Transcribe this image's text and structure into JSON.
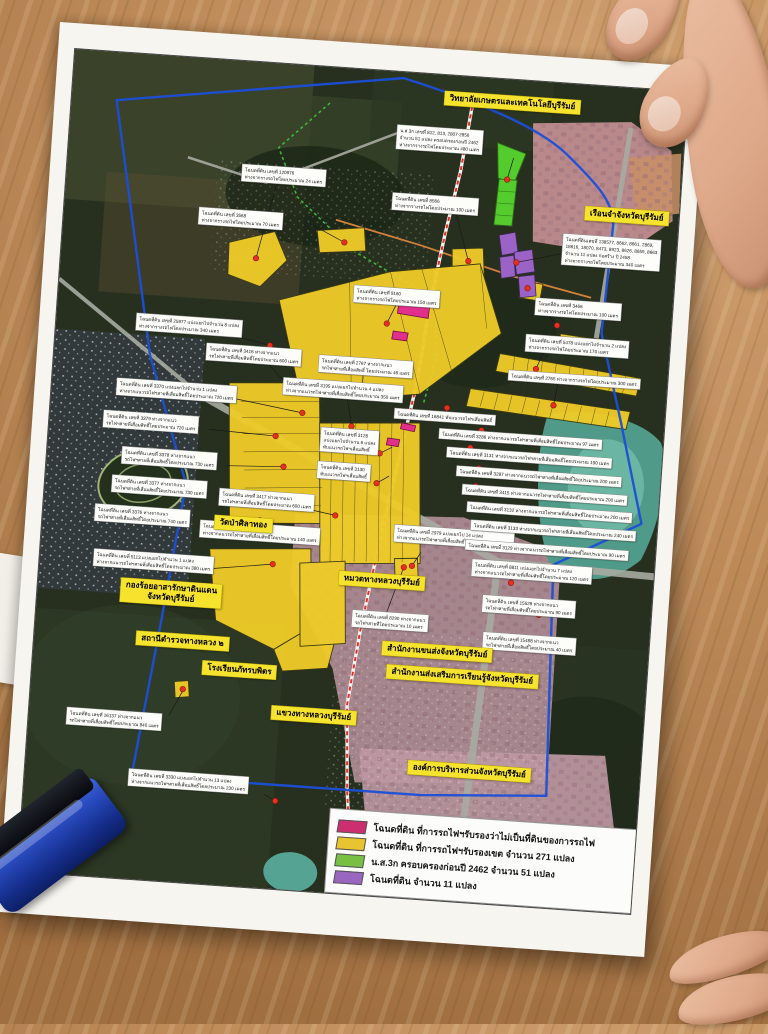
{
  "scene": {
    "description": "photo of printed land-survey map poster on wooden table",
    "objects": [
      "map-poster",
      "blue-self-inking-stamp",
      "hand-top-right",
      "hand-bottom-right",
      "paper-sheet-under-poster"
    ]
  },
  "map_colors": {
    "boundary_blue": "#1b4fd8",
    "railway_red": "#e03222",
    "survey_green": "#3db53d",
    "road_orange": "#d2813a",
    "marker_red": "#e5301f",
    "parcel_yellow": "#eecb28",
    "parcel_green": "#55cc2e",
    "parcel_purple": "#9c63c6",
    "parcel_pink": "#e0308c"
  },
  "legend": {
    "items": [
      {
        "color": "#cc2f70",
        "label": "โฉนดที่ดิน ที่การรถไฟฯรับรองว่าไม่เป็นที่ดินของการรถไฟ"
      },
      {
        "color": "#e9c431",
        "label": "โฉนดที่ดิน ที่การรถไฟฯรับรองเขต จำนวน 271 แปลง"
      },
      {
        "color": "#77c043",
        "label": "น.ส.3ก ครอบครองก่อนปี 2462 จำนวน 51 แปลง"
      },
      {
        "color": "#9a67c0",
        "label": "โฉนดที่ดิน จำนวน 11 แปลง"
      }
    ]
  },
  "place_labels": [
    {
      "x": 372,
      "y": 16,
      "lines": [
        "วิทยาลัยเกษตรและเทคโนโลยีบุรีรัมย์"
      ]
    },
    {
      "x": 520,
      "y": 121,
      "lines": [
        "เรือนจำจังหวัดบุรีรัมย์"
      ]
    },
    {
      "x": 83,
      "y": 524,
      "lines": [
        "กองร้อยอาสารักษาดินแดน",
        "จังหวัดบุรีรัมย์"
      ]
    },
    {
      "x": 102,
      "y": 576,
      "lines": [
        "สถานีตำรวจทางหลวง ๒"
      ]
    },
    {
      "x": 172,
      "y": 455,
      "lines": [
        "วัดป่าศิลาทอง"
      ]
    },
    {
      "x": 300,
      "y": 502,
      "lines": [
        "หมวดทางหลวงบุรีรัมย์"
      ]
    },
    {
      "x": 348,
      "y": 569,
      "lines": [
        "สำนักงานขนส่งจังหวัดบุรีรัมย์"
      ]
    },
    {
      "x": 354,
      "y": 592,
      "lines": [
        "สำนักงานส่งเสริมการเรียนรู้จังหวัดบุรีรัมย์"
      ]
    },
    {
      "x": 170,
      "y": 601,
      "lines": [
        "โรงเรียนภัทรบพิตร"
      ]
    },
    {
      "x": 242,
      "y": 641,
      "lines": [
        "แขวงทางหลวงบุรีรัมย์"
      ]
    },
    {
      "x": 382,
      "y": 686,
      "lines": [
        "องค์การบริหารส่วนจังหวัดบุรีรัมย์"
      ]
    }
  ],
  "parcel_labels": [
    {
      "x": 175,
      "y": 103,
      "lines": [
        "โฉนดที่ดิน เลขที่ 120976",
        "ห่างจากรางรถไฟโดยประมาณ 24 เมตร"
      ]
    },
    {
      "x": 135,
      "y": 149,
      "lines": [
        "โฉนดที่ดิน เลขที่ 3568",
        "ห่างจากรางรถไฟโดยประมาณ 70 เมตร"
      ]
    },
    {
      "x": 327,
      "y": 121,
      "lines": [
        "โฉนดที่ดิน เลขที่ 8566",
        "ห่างจากรางรถไฟโดยประมาณ 100 เมตร"
      ]
    },
    {
      "x": 327,
      "y": 53,
      "lines": [
        "น.ส.3ก เลขที่ 812, 813, 2807-2856",
        "จำนวน 51 แปลง ครอบครองก่อนปี 2462",
        "ห่างจากรางรถไฟโดยประมาณ 480 เมตร"
      ]
    },
    {
      "x": 295,
      "y": 216,
      "lines": [
        "โฉนดที่ดิน เลขที่ 9160",
        "ห่างจากรางรถไฟโดยประมาณ 150 เมตร"
      ]
    },
    {
      "x": 500,
      "y": 150,
      "lines": [
        "โฉนดที่ดินเลขที่ 138577, 8662, 8661, 2869,",
        "18616, 18070, 8473, 8923, 8626, 8659, 8663",
        "จำนวน 11 แปลง ก่อสร้าง ปี 2458",
        "ห่างจากรางรถไฟโดยประมาณ 340 เมตร"
      ]
    },
    {
      "x": 477,
      "y": 216,
      "lines": [
        "โฉนดที่ดิน เลขที่ 3466",
        "ห่างจากรางรถไฟโดยประมาณ 100 เมตร"
      ]
    },
    {
      "x": 470,
      "y": 253,
      "lines": [
        "โฉนดที่ดิน เลขที่ 5478 แบ่งแยกไปจำนวน 2 แปลง",
        "ห่างจากรางรถไฟโดยประมาณ 170 เมตร"
      ]
    },
    {
      "x": 455,
      "y": 290,
      "lines": [
        "โฉนดที่ดิน เลขที่ 2765 ห่างจากรางรถไฟโดยประมาณ 300 เมตร"
      ]
    },
    {
      "x": 80,
      "y": 259,
      "lines": [
        "โฉนดที่ดิน เลขที่ 25977 แบ่งแยกไปจำนวน 8 แปลง",
        "ห่างจากรางรถไฟโดยประมาณ 340 เมตร"
      ]
    },
    {
      "x": 152,
      "y": 284,
      "lines": [
        "โฉนดที่ดิน เลขที่ 3416 ห่างจากแนว",
        "รถไฟฯสายที่เสื่อมสิทธิ์โดยประมาณ 600 เมตร"
      ]
    },
    {
      "x": 265,
      "y": 288,
      "lines": [
        "โฉนดที่ดิน เลขที่ 2767 ห่างจากแนว",
        "รถไฟฯสายที่เสื่อมสิทธิ์ โดยประมาณ 46 เมตร"
      ]
    },
    {
      "x": 231,
      "y": 313,
      "lines": [
        "โฉนดที่ดิน เลขที่ 3195 แบ่งแยกไปจำนวน 4 แปลง",
        "ห่างจากแนวรถไฟฯสายที่เสื่อมสิทธิ์โดยประมาณ 350 เมตร"
      ]
    },
    {
      "x": 65,
      "y": 325,
      "lines": [
        "โฉนดที่ดิน เลขที่ 3370 แบ่งแยกไปจำนวน 1 แปลง",
        "ห่างจากแนวรถไฟฯสายที่เสื่อมสิทธิ์โดยประมาณ 720 เมตร"
      ]
    },
    {
      "x": 54,
      "y": 358,
      "lines": [
        "โฉนดที่ดิน เลขที่ 3379 ห่างจากแนว",
        "รถไฟฯสายที่เสื่อมสิทธิ์โดยประมาณ 720 เมตร"
      ]
    },
    {
      "x": 75,
      "y": 393,
      "lines": [
        "โฉนดที่ดิน เลขที่ 3378 ห่างจากแนว",
        "รถไฟฯสายที่เสื่อมสิทธิ์โดยประมาณ 730 เมตร"
      ]
    },
    {
      "x": 67,
      "y": 422,
      "lines": [
        "โฉนดที่ดิน เลขที่ 3377 ห่างจากแนว",
        "รถไฟฯสายที่เสื่อมสิทธิ์โดยประมาณ 730 เมตร"
      ]
    },
    {
      "x": 52,
      "y": 452,
      "lines": [
        "โฉนดที่ดิน เลขที่ 3376 ห่างจากแนว",
        "รถไฟฯสายที่เสื่อมสิทธิ์โดยประมาณ 740 เมตร"
      ]
    },
    {
      "x": 54,
      "y": 497,
      "lines": [
        "โฉนดที่ดิน เลขที่ 5113 แบ่งแยกไปจำนวน 1 แปลง",
        "ห่างจากแนวรถไฟฯสายที่เสื่อมสิทธิ์โดยประมาณ 380 เมตร"
      ]
    },
    {
      "x": 175,
      "y": 428,
      "lines": [
        "โฉนดที่ดิน เลขที่ 3417 ห่างจากแนว",
        "รถไฟฯสายที่เสื่อมสิทธิ์โดยประมาณ 600 เมตร"
      ]
    },
    {
      "x": 158,
      "y": 461,
      "lines": [
        "โฉนดที่ดิน  65 แปลง",
        "ห่างจากแนวรถไฟฯสายที่เสื่อมสิทธิ์โดยประมาณ 140 เมตร"
      ]
    },
    {
      "x": 352,
      "y": 452,
      "lines": [
        "โฉนดที่ดิน เลขที่ 2979 แบ่งแยกไป 14 แปลง",
        "ห่างจากแนวรถไฟฯสายที่เสื่อมสิทธิ์โดยประมาณ 130 เมตร"
      ]
    },
    {
      "x": 272,
      "y": 360,
      "lines": [
        "โฉนดที่ดิน เลขที่ 3128",
        "แบ่งแยกไปจำนวน 6 แปลง",
        "ทับแนวรถไฟฯเสื่อมสิทธิ์"
      ]
    },
    {
      "x": 271,
      "y": 394,
      "lines": [
        "โฉนดที่ดิน เลขที่ 3130",
        "ทับแนวรถไฟฯเสื่อมสิทธิ์"
      ]
    },
    {
      "x": 344,
      "y": 336,
      "lines": [
        "โฉนดที่ดิน เลขที่ 16841 ทับแนวรถไฟฯเสื่อมสิทธิ์"
      ]
    },
    {
      "x": 390,
      "y": 353,
      "lines": [
        "โฉนดที่ดิน เลขที่ 3286 ห่างจากแนวรถไฟฯสายที่เสื่อมสิทธิ์โดยประมาณ 97 เมตร"
      ]
    },
    {
      "x": 399,
      "y": 371,
      "lines": [
        "โฉนดที่ดิน เลขที่ 3131 ห่างจากแนวรถไฟฯสายที่เสื่อมสิทธิ์โดยประมาณ 190 เมตร"
      ]
    },
    {
      "x": 410,
      "y": 389,
      "lines": [
        "โฉนดที่ดิน เลขที่ 3287 ห่างจากแนวรถไฟฯสายที่เสื่อมสิทธิ์โดยประมาณ 200 เมตร"
      ]
    },
    {
      "x": 417,
      "y": 407,
      "lines": [
        "โฉนดที่ดิน เลขที่ 3415 ห่างจากแนวรถไฟฯสายที่เสื่อมสิทธิ์โดยประมาณ 200 เมตร"
      ]
    },
    {
      "x": 423,
      "y": 424,
      "lines": [
        "โฉนดที่ดิน เลขที่ 3132 ห่างจากแนวรถไฟฯสายที่เสื่อมสิทธิ์โดยประมาณ 200 เมตร"
      ]
    },
    {
      "x": 428,
      "y": 442,
      "lines": [
        "โฉนดที่ดิน เลขที่ 3133 ห่างจากแนวรถไฟฯสายที่เสื่อมสิทธิ์โดยประมาณ 240 เมตร"
      ]
    },
    {
      "x": 424,
      "y": 462,
      "lines": [
        "โฉนดที่ดิน เลขที่ 3129 ห่างจากแนวรถไฟฯสายที่เสื่อมสิทธิ์โดยประมาณ 90 เมตร"
      ]
    },
    {
      "x": 432,
      "y": 481,
      "lines": [
        "โฉนดที่ดิน เลขที่ 8811 แบ่งแยกไปจำนวน 7 แปลง",
        "ห่างจากแนวรถไฟฯสายที่เสื่อมสิทธิ์โดยประมาณ 120 เมตร"
      ]
    },
    {
      "x": 445,
      "y": 516,
      "lines": [
        "โฉนดที่ดิน เลขที่ 15528 ห่างจากแนว",
        "รถไฟฯสายที่เสื่อมสิทธิ์โดยประมาณ 90 เมตร"
      ]
    },
    {
      "x": 316,
      "y": 540,
      "lines": [
        "โฉนดที่ดิน เลขที่ 8290 ห่างจากแนว",
        "รถไฟฯสายที่โดยประมาณ 10 เมตร"
      ]
    },
    {
      "x": 448,
      "y": 553,
      "lines": [
        "โฉนดที่ดิน เลขที่ 15488 ห่างจากแนว",
        "รถไฟฯสายที่เสื่อมสิทธิ์โดยประมาณ 40 เมตร"
      ]
    },
    {
      "x": 38,
      "y": 657,
      "lines": [
        "โฉนดที่ดิน เลขที่ 16137 ห่างจากแนว",
        "รถไฟฯสายที่เสื่อมสิทธิ์โดยประมาณ 840 เมตร"
      ]
    },
    {
      "x": 104,
      "y": 714,
      "lines": [
        "โฉนดที่ดิน เลขที่ 3330 แบ่งแยกไปจำนวน 13 แปลง",
        "ห่างจากแนวรถไฟฯสายที่เสื่อมสิทธิ์โดยประมาณ 230 เมตร"
      ]
    }
  ]
}
